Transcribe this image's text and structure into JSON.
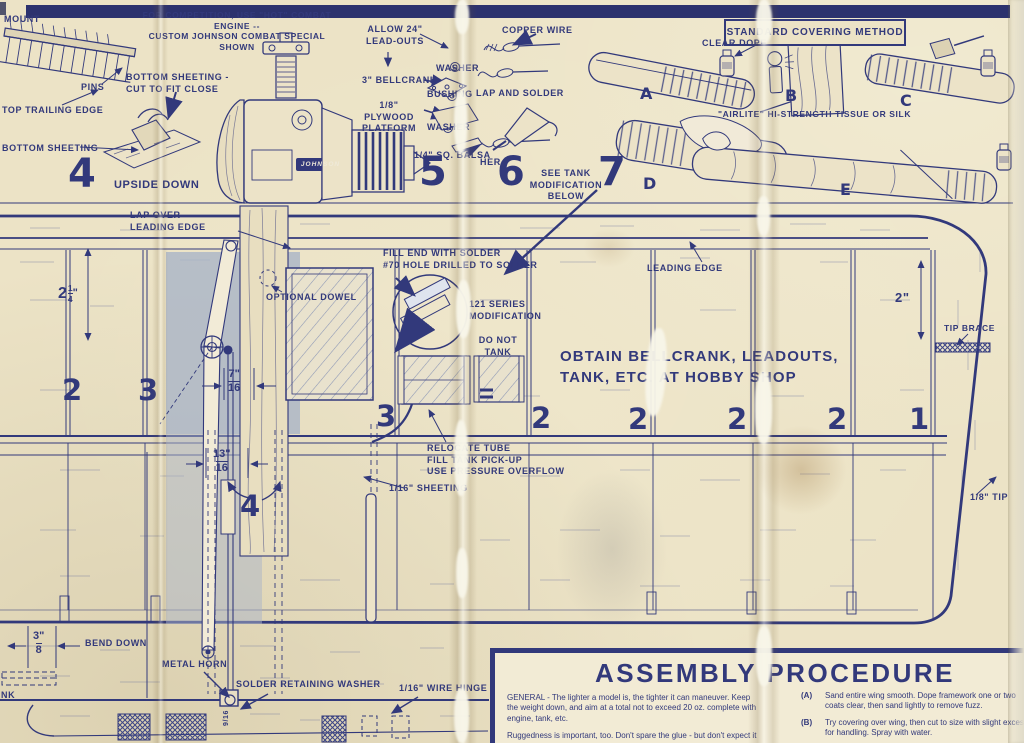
{
  "colors": {
    "ink": "#32397b",
    "paper": "#ece3c6",
    "shade": "#a9b4c7"
  },
  "header": {
    "competition_note": "FOR COMPETITION, USE \"HOT\" COMBAT ENGINE --\nCUSTOM JOHNSON COMBAT SPECIAL SHOWN"
  },
  "steps": {
    "step4": {
      "number": "4",
      "mount": "MOUNT",
      "pins": "PINS",
      "top_trailing_edge": "TOP TRAILING EDGE",
      "bottom_sheeting_cut": "BOTTOM SHEETING -\nCUT TO FIT CLOSE",
      "bottom_sheeting": "BOTTOM SHEETING",
      "upside_down": "UPSIDE DOWN"
    },
    "step5": {
      "number": "5",
      "allow_leadouts": "ALLOW 24\"\nLEAD-OUTS",
      "washer_top": "WASHER",
      "bellcrank": "3\" BELLCRANK",
      "bushing": "BUSHING",
      "plywood_platform": "1/8\" PLYWOOD\nPLATFORM",
      "washer_bottom": "WASHER",
      "square_balsa": "1/4\" SQ. BALSA",
      "engine_badge": "JOHNSON"
    },
    "step6": {
      "number": "6",
      "copper_wire": "COPPER WIRE",
      "lap_and_solder": "LAP AND SOLDER",
      "washer_fragment": "HER",
      "see_tank_note": "SEE TANK\nMODIFICATION\nBELOW"
    },
    "step7": {
      "number": "7"
    }
  },
  "covering": {
    "title": "STANDARD COVERING METHOD",
    "clear_dope": "CLEAR DOPE",
    "tissue_note": "\"AIRLITE\" HI-STRENGTH TISSUE OR SILK",
    "letters": [
      "A",
      "B",
      "C",
      "D",
      "E"
    ]
  },
  "plan": {
    "labels": {
      "lap_over": "LAP OVER\nLEADING EDGE",
      "optional_dowel": "OPTIONAL DOWEL",
      "fill_end": "FILL END WITH SOLDER\n#70 HOLE DRILLED TO SOLDER",
      "series_modification": "121 SERIES\nMODIFICATION",
      "do_not_tank": "DO NOT\nTANK",
      "obtain_note": "OBTAIN BELLCRANK, LEADOUTS,\nTANK, ETC. AT HOBBY SHOP",
      "leading_edge": "LEADING EDGE",
      "tip_brace": "TIP BRACE",
      "tip": "1/8\" TIP",
      "relocate": "RELOCATE TUBE\nFILL TANK PICK-UP\nUSE PRESSURE OVERFLOW",
      "sheeting": "1/16\" SHEETING",
      "bend_down": "BEND DOWN",
      "metal_horn": "METAL HORN",
      "solder_washer": "SOLDER RETAINING WASHER",
      "wire_hinge": "1/16\" WIRE HINGE",
      "edge_fragment": "NK",
      "pushrod_dim": "9/16"
    },
    "dims": {
      "d214": {
        "whole": "2",
        "num": "1",
        "den": "4",
        "unit": "\""
      },
      "d2": "2\"",
      "d716": {
        "num": "7\"",
        "den": "16"
      },
      "d1316": {
        "num": "13\"",
        "den": "16"
      },
      "d38": {
        "num": "3\"",
        "den": "8"
      }
    },
    "rib_numbers": [
      "2",
      "3",
      "3",
      "2",
      "2",
      "2",
      "2",
      "1"
    ],
    "detail_number": "4"
  },
  "assembly": {
    "title": "ASSEMBLY PROCEDURE",
    "general": [
      "GENERAL - The lighter a model is, the tighter it can maneuver. Keep the weight down, and aim at a total not to exceed 20 oz. complete with engine, tank, etc.",
      "Ruggedness is important, too.  Don't spare the glue - but don't expect it to make up for sloppy joints."
    ],
    "items": [
      {
        "tag": "(A)",
        "text": "Sand entire wing smooth. Dope framework one or two coats clear, then sand lightly to remove fuzz."
      },
      {
        "tag": "(B)",
        "text": "Try covering over wing, then cut to size with slight excess for handling.  Spray with water."
      },
      {
        "tag": "(C)",
        "text": "Apply dope to center of bottom of wing, and lay damp covering"
      }
    ]
  }
}
